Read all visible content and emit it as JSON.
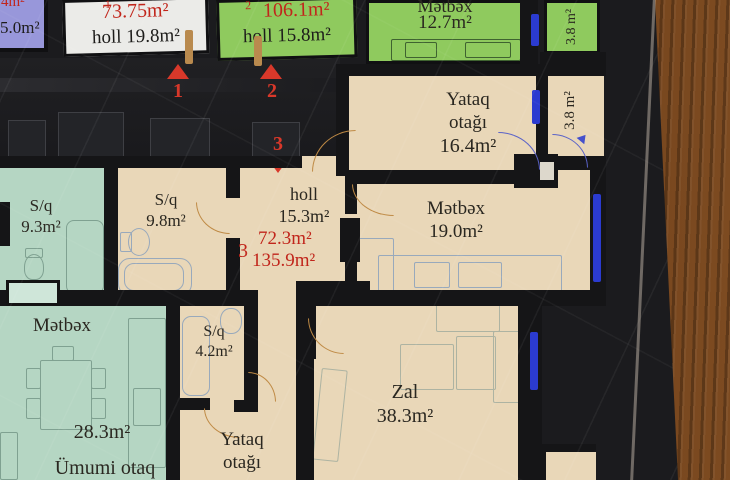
{
  "colors": {
    "red_accent": "#c1251b",
    "marker_red": "#d8382a",
    "window_blue": "#2b3bd0",
    "door_orange": "#bf8a45",
    "wall_black": "#151517",
    "beige_room": "#e9d7b8",
    "teal_room": "#b5d6c3",
    "green_room": "#8fca5e",
    "purple_box": "#9897da",
    "wood_brown": "#6e3f1b"
  },
  "legend_boxes": {
    "partial": {
      "area_red": "4m²",
      "area_black": "5.0m²"
    },
    "unit1": {
      "number": "1",
      "area": "73.75m²",
      "holl": "holl 19.8m²"
    },
    "unit2": {
      "number": "2",
      "area": "106.1m²",
      "holl": "holl 15.8m²"
    }
  },
  "markers": {
    "one": "1",
    "two": "2",
    "three": "3"
  },
  "rooms": {
    "metbex_green": {
      "name": "Mətbəx",
      "area": "12.7m²"
    },
    "balcony_green": {
      "area": "3.8 m²"
    },
    "yataq_main": {
      "name_line1": "Yataq",
      "name_line2": "otağı",
      "area": "16.4m²"
    },
    "balcony_beige": {
      "area": "3.8 m²"
    },
    "metbex_main": {
      "name": "Mətbəx",
      "area": "19.0m²"
    },
    "holl": {
      "name": "holl",
      "area": "15.3m²"
    },
    "unit3": {
      "number": "3",
      "area_living": "72.3m²",
      "area_total": "135.9m²"
    },
    "sq_mid": {
      "name": "S/q",
      "area": "9.8m²"
    },
    "sq_left": {
      "name": "S/q",
      "area": "9.3m²"
    },
    "metbex_left": {
      "name": "Mətbəx",
      "area": "28.3m²",
      "secondary_name": "Ümumi otaq"
    },
    "sq_small": {
      "name": "S/q",
      "area": "4.2m²"
    },
    "yataq_small": {
      "name_line1": "Yataq",
      "name_line2": "otağı"
    },
    "zal": {
      "name": "Zal",
      "area": "38.3m²"
    }
  }
}
